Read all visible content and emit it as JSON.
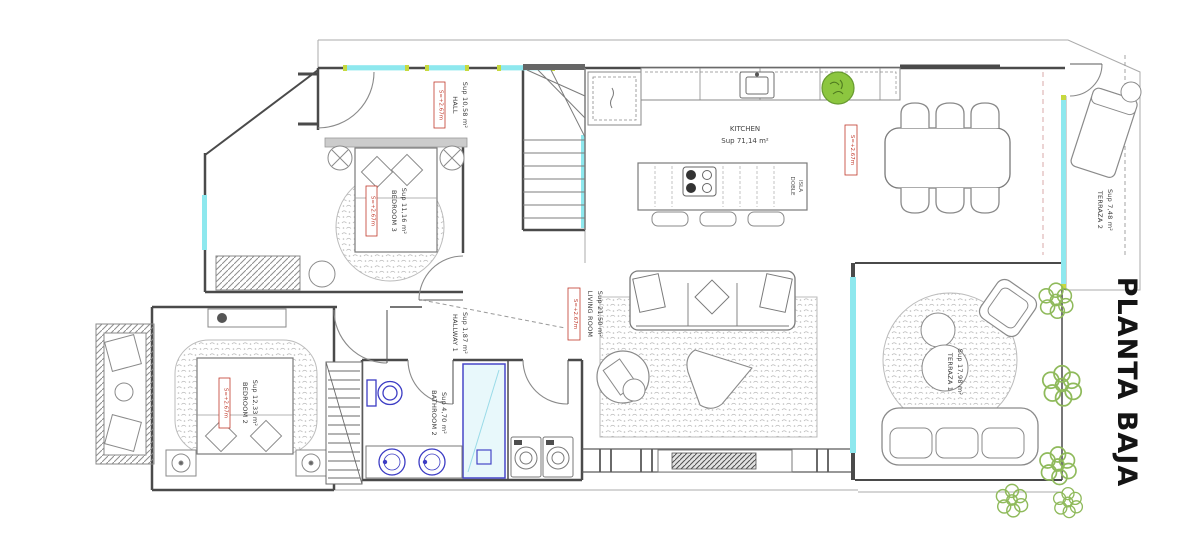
{
  "title": {
    "text": "PLANTA BAJA"
  },
  "labels": {
    "level_mark": "S=+2.67m",
    "hall": {
      "name": "HALL",
      "area": "Sup 10,58 m²"
    },
    "kitchen": {
      "name": "KITCHEN",
      "area": "Sup 71,14 m²"
    },
    "island": {
      "line1": "DOBLE",
      "line2": "ISLA"
    },
    "bedroom3": {
      "name": "BEDROOM 3",
      "area": "Sup 11,16 m²"
    },
    "bedroom2": {
      "name": "BEDROOM 2",
      "area": "Sup 12,33 m²"
    },
    "bathroom2": {
      "name": "BATHROOM 2",
      "area": "Sup 4,70 m²"
    },
    "hallway1": {
      "name": "HALLWAY 1",
      "area": "Sup 1,87 m²"
    },
    "living": {
      "name": "LIVING ROOM",
      "area": "Sup 21,50 m²"
    },
    "terraza1": {
      "name": "TERRAZA 1",
      "area": "Sup 17,98 m²"
    },
    "terraza2": {
      "name": "TERRAZA 2",
      "area": "Sup 7,48 m²"
    }
  },
  "colors": {
    "window_glass": "#8ee8ee",
    "fixture_blue": "#3c3cc4",
    "label_red": "#c0392b",
    "plant_green": "#8fba5b",
    "window_tick_lime": "#c6d93f"
  }
}
